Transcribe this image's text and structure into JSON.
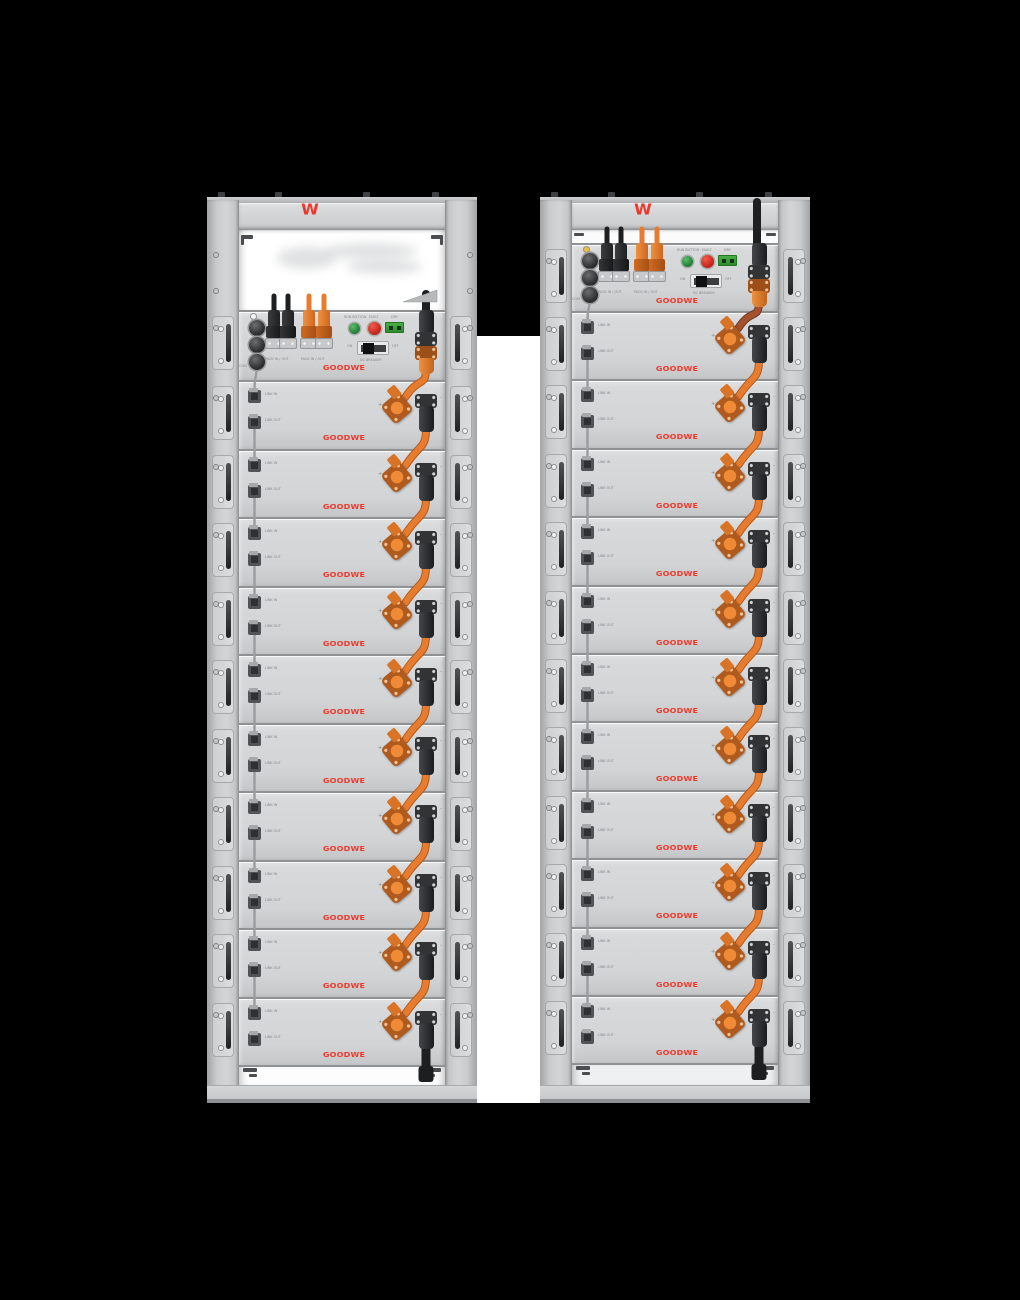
{
  "scene": {
    "description": "Two GoodWe rack-mounted battery storage towers on black background",
    "colors": {
      "background": "#000000",
      "backdrop": "#ffffff",
      "brand_red": "#ee372b",
      "cable_orange": "#e87c2e",
      "cable_orange_dark": "#b35a1d",
      "link_cable_gray": "#9a9ca0",
      "cable_black": "#1d1f21"
    }
  },
  "brand": {
    "mark": "W",
    "wordmark": "GOODWE"
  },
  "control_module": {
    "run_label": "RUN BUTTON",
    "fault_label": "FAULT",
    "dry_label": "DRY",
    "on_label": "ON",
    "off_label": "OFF",
    "breaker_label": "DC BREAKER",
    "pack_label": "PACK IN / OUT",
    "com_label": "COM"
  },
  "battery_module": {
    "link_in": "LINK IN",
    "link_out": "LINK OUT",
    "plus": "+",
    "minus": "-"
  },
  "racks": [
    {
      "name": "rack-left",
      "battery_count": 10,
      "empty_top_bay": true,
      "indicator_color": "#f4f5f6",
      "first_jumper_color": "#e87c2e",
      "first_jumper_dark": "#b35a1d",
      "top_cable_over_header": false,
      "bottom_gap_color": "#fdfdfd"
    },
    {
      "name": "rack-right",
      "battery_count": 11,
      "empty_top_bay": false,
      "indicator_color": "#f0bf3a",
      "first_jumper_color": "#a4522d",
      "first_jumper_dark": "#6e3a20",
      "top_cable_over_header": true,
      "bottom_gap_color": "#eef0f1"
    }
  ]
}
